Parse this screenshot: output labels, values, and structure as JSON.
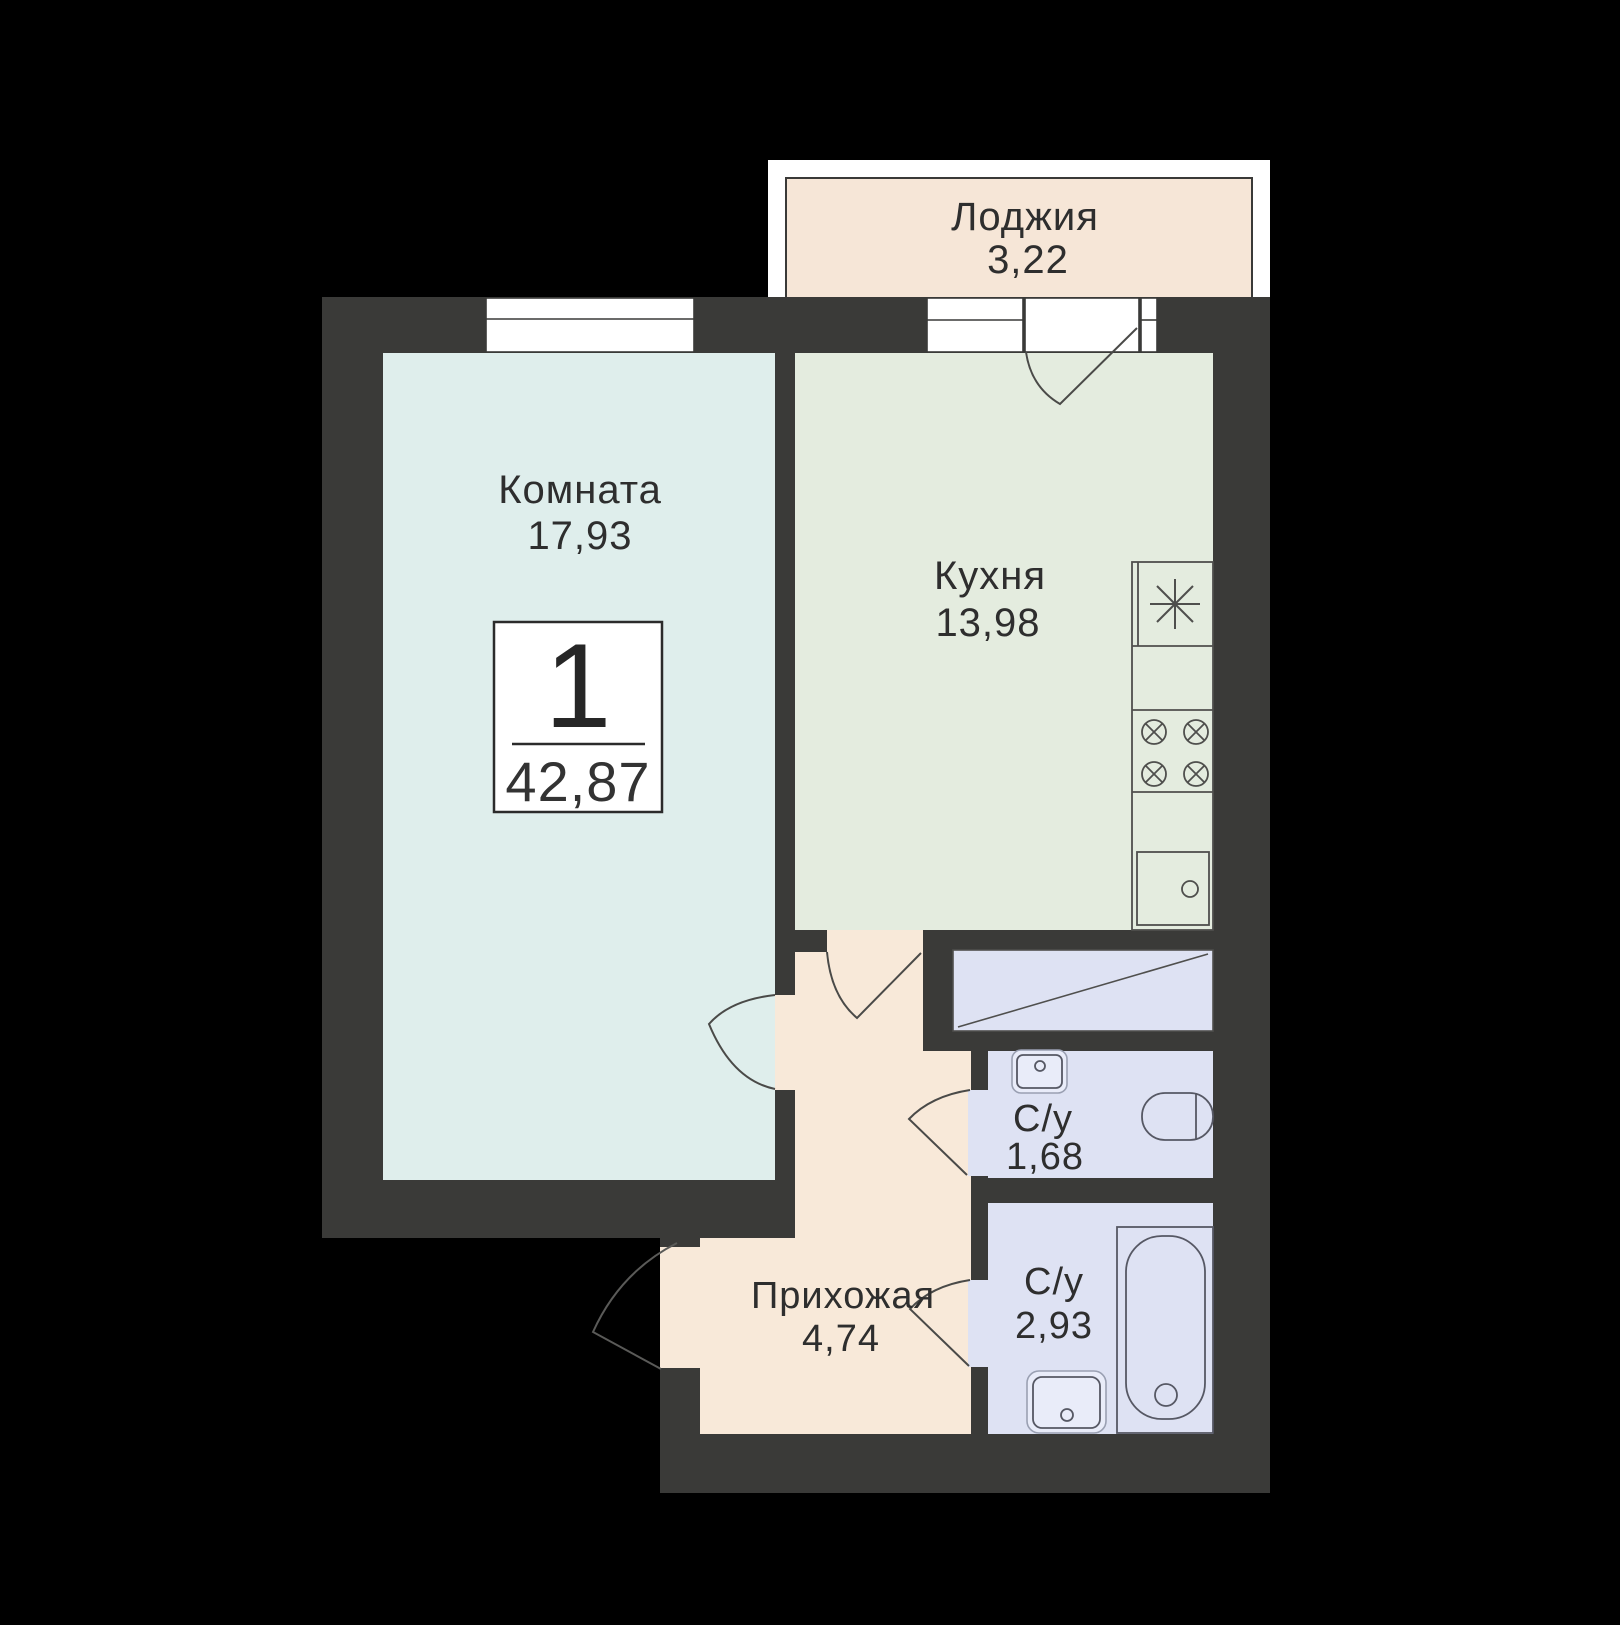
{
  "floorplan": {
    "badge": {
      "rooms_count": "1",
      "total_area": "42,87"
    },
    "loggia": {
      "label": "Лоджия",
      "area": "3,22"
    },
    "room": {
      "label": "Комната",
      "area": "17,93"
    },
    "kitchen": {
      "label": "Кухня",
      "area": "13,98"
    },
    "hallway": {
      "label": "Прихожая",
      "area": "4,74"
    },
    "bathroom1": {
      "label": "С/у",
      "area": "1,68"
    },
    "bathroom2": {
      "label": "С/у",
      "area": "2,93"
    },
    "colors": {
      "background": "#000000",
      "wall": "#3a3a38",
      "room_floor": "#dfeeec",
      "kitchen_floor": "#e4ecdf",
      "hallway_floor": "#f8e9d9",
      "loggia_floor": "#f6e6d7",
      "bathroom_floor": "#dee2f3",
      "fixture_fill": "#e9ecf9",
      "frame_white": "#ffffff"
    }
  }
}
